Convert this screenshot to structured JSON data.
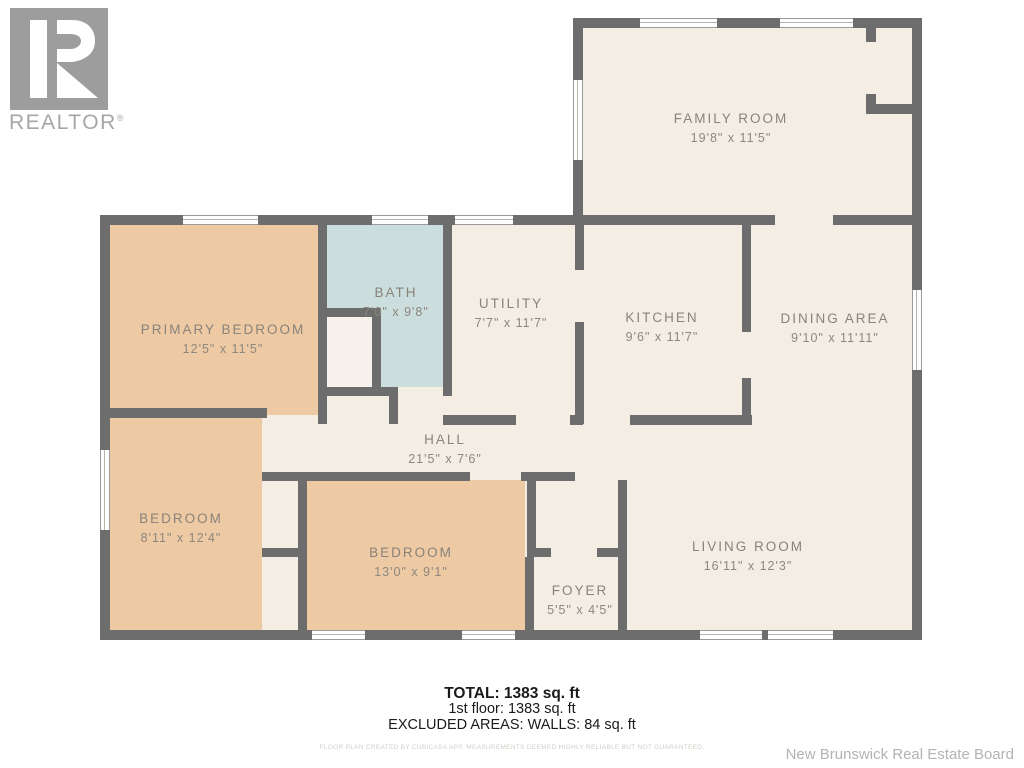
{
  "branding": {
    "logo_text": "REALTOR",
    "reg": "®",
    "board_name": "New Brunswick Real Estate Board"
  },
  "rooms": {
    "family_room": {
      "name": "FAMILY ROOM",
      "dims": "19'8\" x 11'5\""
    },
    "primary_bedroom": {
      "name": "PRIMARY BEDROOM",
      "dims": "12'5\" x 11'5\""
    },
    "bath": {
      "name": "BATH",
      "dims": "7'0\" x 9'8\""
    },
    "utility": {
      "name": "UTILITY",
      "dims": "7'7\" x 11'7\""
    },
    "kitchen": {
      "name": "KITCHEN",
      "dims": "9'6\" x 11'7\""
    },
    "dining_area": {
      "name": "DINING AREA",
      "dims": "9'10\" x 11'11\""
    },
    "hall": {
      "name": "HALL",
      "dims": "21'5\" x 7'6\""
    },
    "bedroom_left": {
      "name": "BEDROOM",
      "dims": "8'11\" x 12'4\""
    },
    "bedroom_mid": {
      "name": "BEDROOM",
      "dims": "13'0\" x 9'1\""
    },
    "foyer": {
      "name": "FOYER",
      "dims": "5'5\" x 4'5\""
    },
    "living_room": {
      "name": "LIVING ROOM",
      "dims": "16'11\" x 12'3\""
    }
  },
  "summary": {
    "total": "TOTAL: 1383 sq. ft",
    "first_floor": "1st floor: 1383 sq. ft",
    "excluded": "EXCLUDED AREAS: WALLS: 84 sq. ft",
    "disclaimer": "FLOOR PLAN CREATED BY CUBICASA APP. MEASUREMENTS DEEMED HIGHLY RELIABLE BUT NOT GUARANTEED."
  },
  "colors": {
    "wall": "#6d6d6d",
    "floor_cream": "#f3ede4",
    "bedroom_peach": "#edc9a4",
    "bath_blue": "#cbdedd",
    "label_gray": "#89837a"
  }
}
